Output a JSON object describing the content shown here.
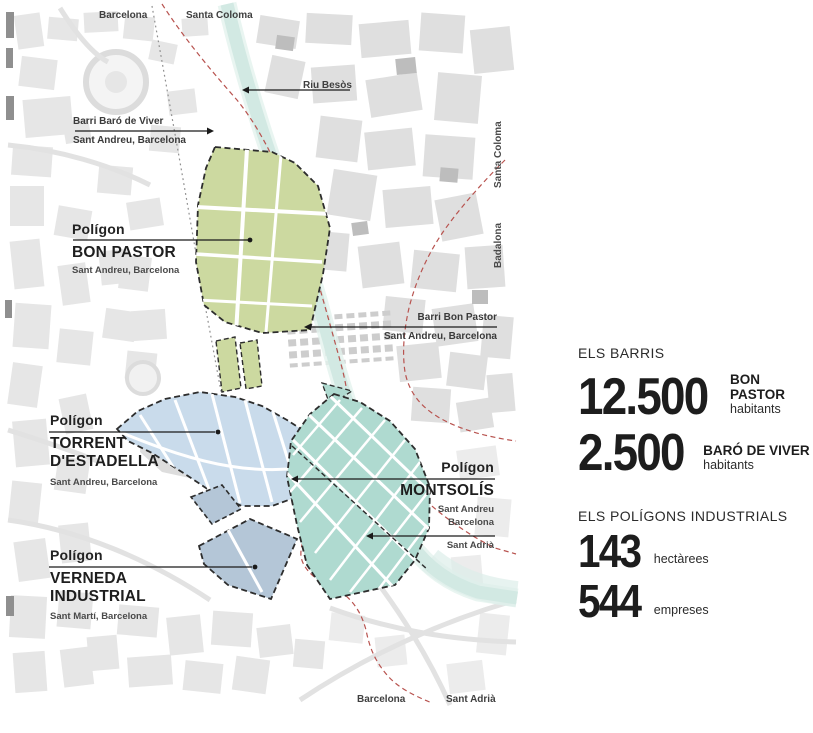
{
  "map": {
    "edge_labels": {
      "top_left": "Barcelona",
      "top_right": "Santa Coloma",
      "right_upper_vertical": "Santa Coloma",
      "right_lower_vertical": "Badalona",
      "bottom_left": "Barcelona",
      "bottom_right": "Sant Adrià"
    },
    "river": {
      "label": "Riu Besòs",
      "color": "#d2e9e3"
    },
    "boundary_color": "#b8534f",
    "neighborhood_callouts": [
      {
        "id": "barri-baro-de-viver",
        "line1": "Barri Baró de Viver",
        "line2": "Sant Andreu, Barcelona"
      },
      {
        "id": "barri-bon-pastor",
        "line1": "Barri Bon Pastor",
        "line2": "Sant Andreu, Barcelona"
      }
    ],
    "poligon_callouts": [
      {
        "id": "bon-pastor",
        "kicker": "Polígon",
        "name1": "BON PASTOR",
        "district": "Sant Andreu, Barcelona",
        "fill": "#ccd9a0"
      },
      {
        "id": "torrent-destadella",
        "kicker": "Polígon",
        "name1": "TORRENT",
        "name2": "D'ESTADELLA",
        "district": "Sant Andreu, Barcelona",
        "fill": "#c9dbeb"
      },
      {
        "id": "montsolis",
        "kicker": "Polígon",
        "name1": "MONTSOLÍS",
        "district1": "Sant Andreu",
        "district2": "Barcelona",
        "district3": "Sant Adrià",
        "fill": "#afdad0"
      },
      {
        "id": "verneda-industrial",
        "kicker": "Polígon",
        "name1": "VERNEDA",
        "name2": "INDUSTRIAL",
        "district": "Sant Martí, Barcelona",
        "fill": "#b4c6d7"
      }
    ]
  },
  "stats": {
    "barris": {
      "heading": "ELS BARRIS",
      "items": [
        {
          "value": "12.500",
          "label": "BON PASTOR",
          "unit": "habitants"
        },
        {
          "value": "2.500",
          "label": "BARÓ DE VIVER",
          "unit": "habitants"
        }
      ]
    },
    "industrial": {
      "heading": "ELS POLÍGONS INDUSTRIALS",
      "items": [
        {
          "value": "143",
          "unit": "hectàrees"
        },
        {
          "value": "544",
          "unit": "empreses"
        }
      ]
    }
  }
}
